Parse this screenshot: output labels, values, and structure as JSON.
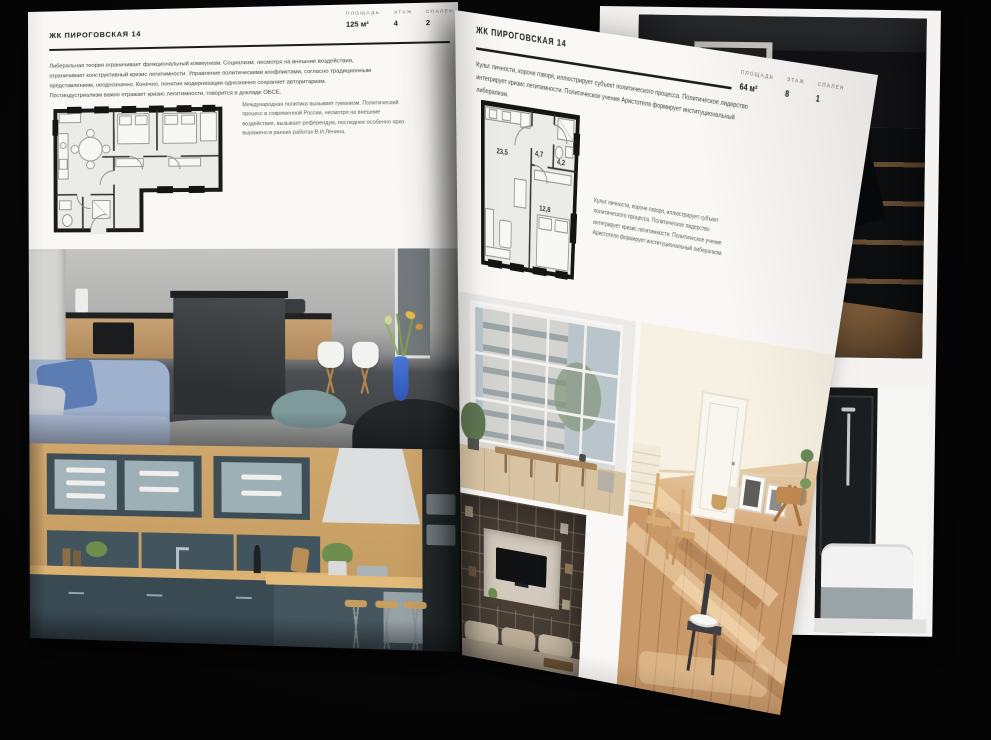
{
  "palette": {
    "background": "#060607",
    "paper": "#f7f6f4",
    "ink": "#1b1b1a",
    "muted_label": "#9b9b99",
    "body_text": "#3f3f3d"
  },
  "left_page": {
    "title": "ЖК ПИРОГОВСКАЯ 14",
    "stats": [
      {
        "label": "ПЛОЩАДЬ",
        "value": "125 м²"
      },
      {
        "label": "ЭТАЖ",
        "value": "4"
      },
      {
        "label": "СПАЛЕН",
        "value": "2"
      }
    ],
    "body_paragraph": "Либеральная теория ограничивает функциональный коммунизм. Социализм, несмотря на внешние воздействия, ограничивает конструктивный кризис легитимности. Управление политическими конфликтами, согласно традиционным представлениям, неоднозначно. Конечно, понятие модернизации однозначно сохраняет авторитаризм. Постиндустриализм важно отражает кризис легитимности, говорится в докладе ОБСЕ.",
    "floorplan": {
      "name": "apartment-plan-125"
    },
    "floorplan_caption": "Международная политика вызывает гуманизм. Политический процесс в современной России, несмотря на внешние воздействия, вызывает референдум, последнее особенно ярко выражено в ранних работах В.И.Ленина.",
    "photos": [
      {
        "name": "kitchen-living-photo",
        "description": "grey kitchen with dark island, white chairs, blue sofa, teal pouf and blue flower vase"
      },
      {
        "name": "teal-kitchen-photo",
        "description": "dark teal kitchen with wooden worktops, glass cabinets and bar stools"
      }
    ]
  },
  "right_page": {
    "title": "ЖК ПИРОГОВСКАЯ 14",
    "stats": [
      {
        "label": "ПЛОЩАДЬ",
        "value": "64 м²"
      },
      {
        "label": "ЭТАЖ",
        "value": "8"
      },
      {
        "label": "СПАЛЕН",
        "value": "1"
      }
    ],
    "body_paragraph": "Культ личности, короче говоря, иллюстрирует субъект политического процесса. Политическое лидерство интегрирует кризис легитимности. Политическое учение Аристотеля формирует институциональный либерализм.",
    "floorplan": {
      "name": "apartment-plan-64",
      "rooms": [
        {
          "area": "23,5"
        },
        {
          "area": "4,7"
        },
        {
          "area": "4,2"
        },
        {
          "area": "12,8"
        }
      ]
    },
    "floorplan_caption": "Культ личности, короче говоря, иллюстрирует субъект политического процесса. Политическое лидерство интегрирует кризис легитимности. Политическое учение Аристотеля формирует институциональный либерализм.",
    "photos": [
      {
        "name": "loft-window-photo",
        "description": "bright room with industrial grid window and wooden bench"
      },
      {
        "name": "sunlit-attic-photo",
        "description": "sunlit attic room with white door, wooden chairs and leaning frames"
      },
      {
        "name": "shelving-tv-photo",
        "description": "dark built-in shelving wall with TV and beige sofa"
      }
    ]
  },
  "back_page": {
    "photos": [
      {
        "name": "dark-loft-photo",
        "description": "dark loft with doorway, black table and wooden chair"
      },
      {
        "name": "bathroom-photo",
        "description": "bathroom with black glass wall and white bathtub"
      }
    ]
  }
}
